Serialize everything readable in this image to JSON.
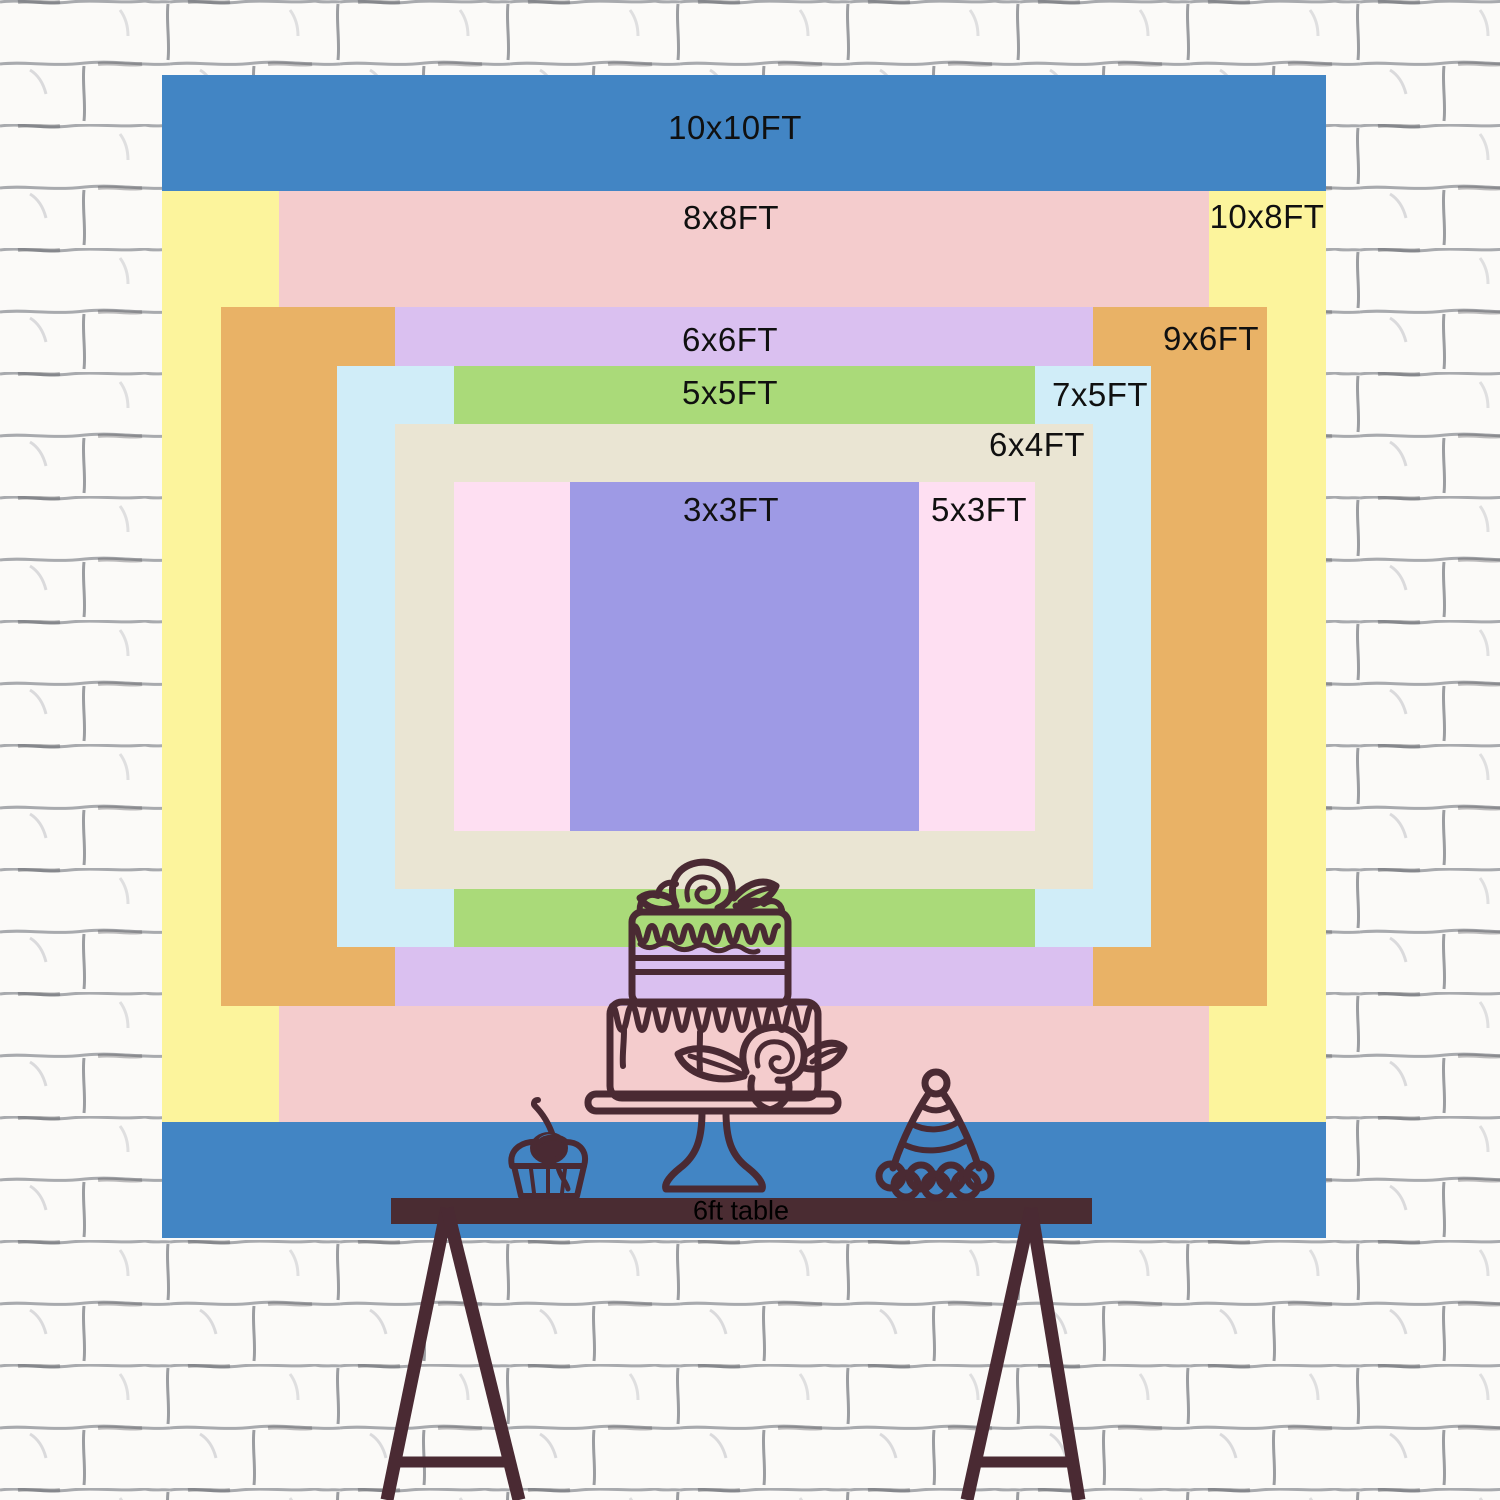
{
  "scene": {
    "description": "Backdrop size comparison chart on white brick wall",
    "wall": {
      "background": "#fbfaf8",
      "mortar_line_color": "#94969b"
    },
    "px_per_ft": 116.3,
    "backdrop_center": {
      "x": 744,
      "y": 656
    }
  },
  "sizes": [
    {
      "label": "10x10FT",
      "w_ft": 10,
      "h_ft": 10,
      "color": "#4285c4",
      "x": 162,
      "y": 75,
      "w": 1164,
      "h": 1163,
      "label_x": 735,
      "label_y": 128
    },
    {
      "label": "10x8FT",
      "w_ft": 10,
      "h_ft": 8,
      "color": "#fcf49c",
      "x": 162,
      "y": 191,
      "w": 1164,
      "h": 931,
      "label_x": 1267,
      "label_y": 217
    },
    {
      "label": "8x8FT",
      "w_ft": 8,
      "h_ft": 8,
      "color": "#f4cccd",
      "x": 279,
      "y": 191,
      "w": 930,
      "h": 931,
      "label_x": 731,
      "label_y": 218
    },
    {
      "label": "9x6FT",
      "w_ft": 9,
      "h_ft": 6,
      "color": "#e9b266",
      "x": 221,
      "y": 307,
      "w": 1046,
      "h": 699,
      "label_x": 1211,
      "label_y": 339
    },
    {
      "label": "6x6FT",
      "w_ft": 6,
      "h_ft": 6,
      "color": "#dac0f0",
      "x": 395,
      "y": 307,
      "w": 698,
      "h": 699,
      "label_x": 730,
      "label_y": 340
    },
    {
      "label": "7x5FT",
      "w_ft": 7,
      "h_ft": 5,
      "color": "#d0edf8",
      "x": 337,
      "y": 366,
      "w": 814,
      "h": 581,
      "label_x": 1100,
      "label_y": 395
    },
    {
      "label": "5x5FT",
      "w_ft": 5,
      "h_ft": 5,
      "color": "#aada79",
      "x": 454,
      "y": 366,
      "w": 581,
      "h": 581,
      "label_x": 730,
      "label_y": 393
    },
    {
      "label": "6x4FT",
      "w_ft": 6,
      "h_ft": 4,
      "color": "#eae5d3",
      "x": 395,
      "y": 424,
      "w": 698,
      "h": 465,
      "label_x": 1037,
      "label_y": 445
    },
    {
      "label": "5x3FT",
      "w_ft": 5,
      "h_ft": 3,
      "color": "#fedff2",
      "x": 454,
      "y": 482,
      "w": 581,
      "h": 349,
      "label_x": 979,
      "label_y": 510
    },
    {
      "label": "3x3FT",
      "w_ft": 3,
      "h_ft": 3,
      "color": "#9e9ae5",
      "x": 570,
      "y": 482,
      "w": 349,
      "h": 349,
      "label_x": 731,
      "label_y": 510
    }
  ],
  "table": {
    "label": "6ft table",
    "surface_color": "#4a2c32",
    "x": 391,
    "y": 1198,
    "w": 701,
    "h": 26,
    "label_x": 741,
    "label_y": 1211
  },
  "illustration": {
    "stroke_color": "#4a2a33",
    "items": [
      "two-tier-cake",
      "cupcake-with-cherry",
      "party-hat",
      "trestle-table-legs"
    ]
  }
}
